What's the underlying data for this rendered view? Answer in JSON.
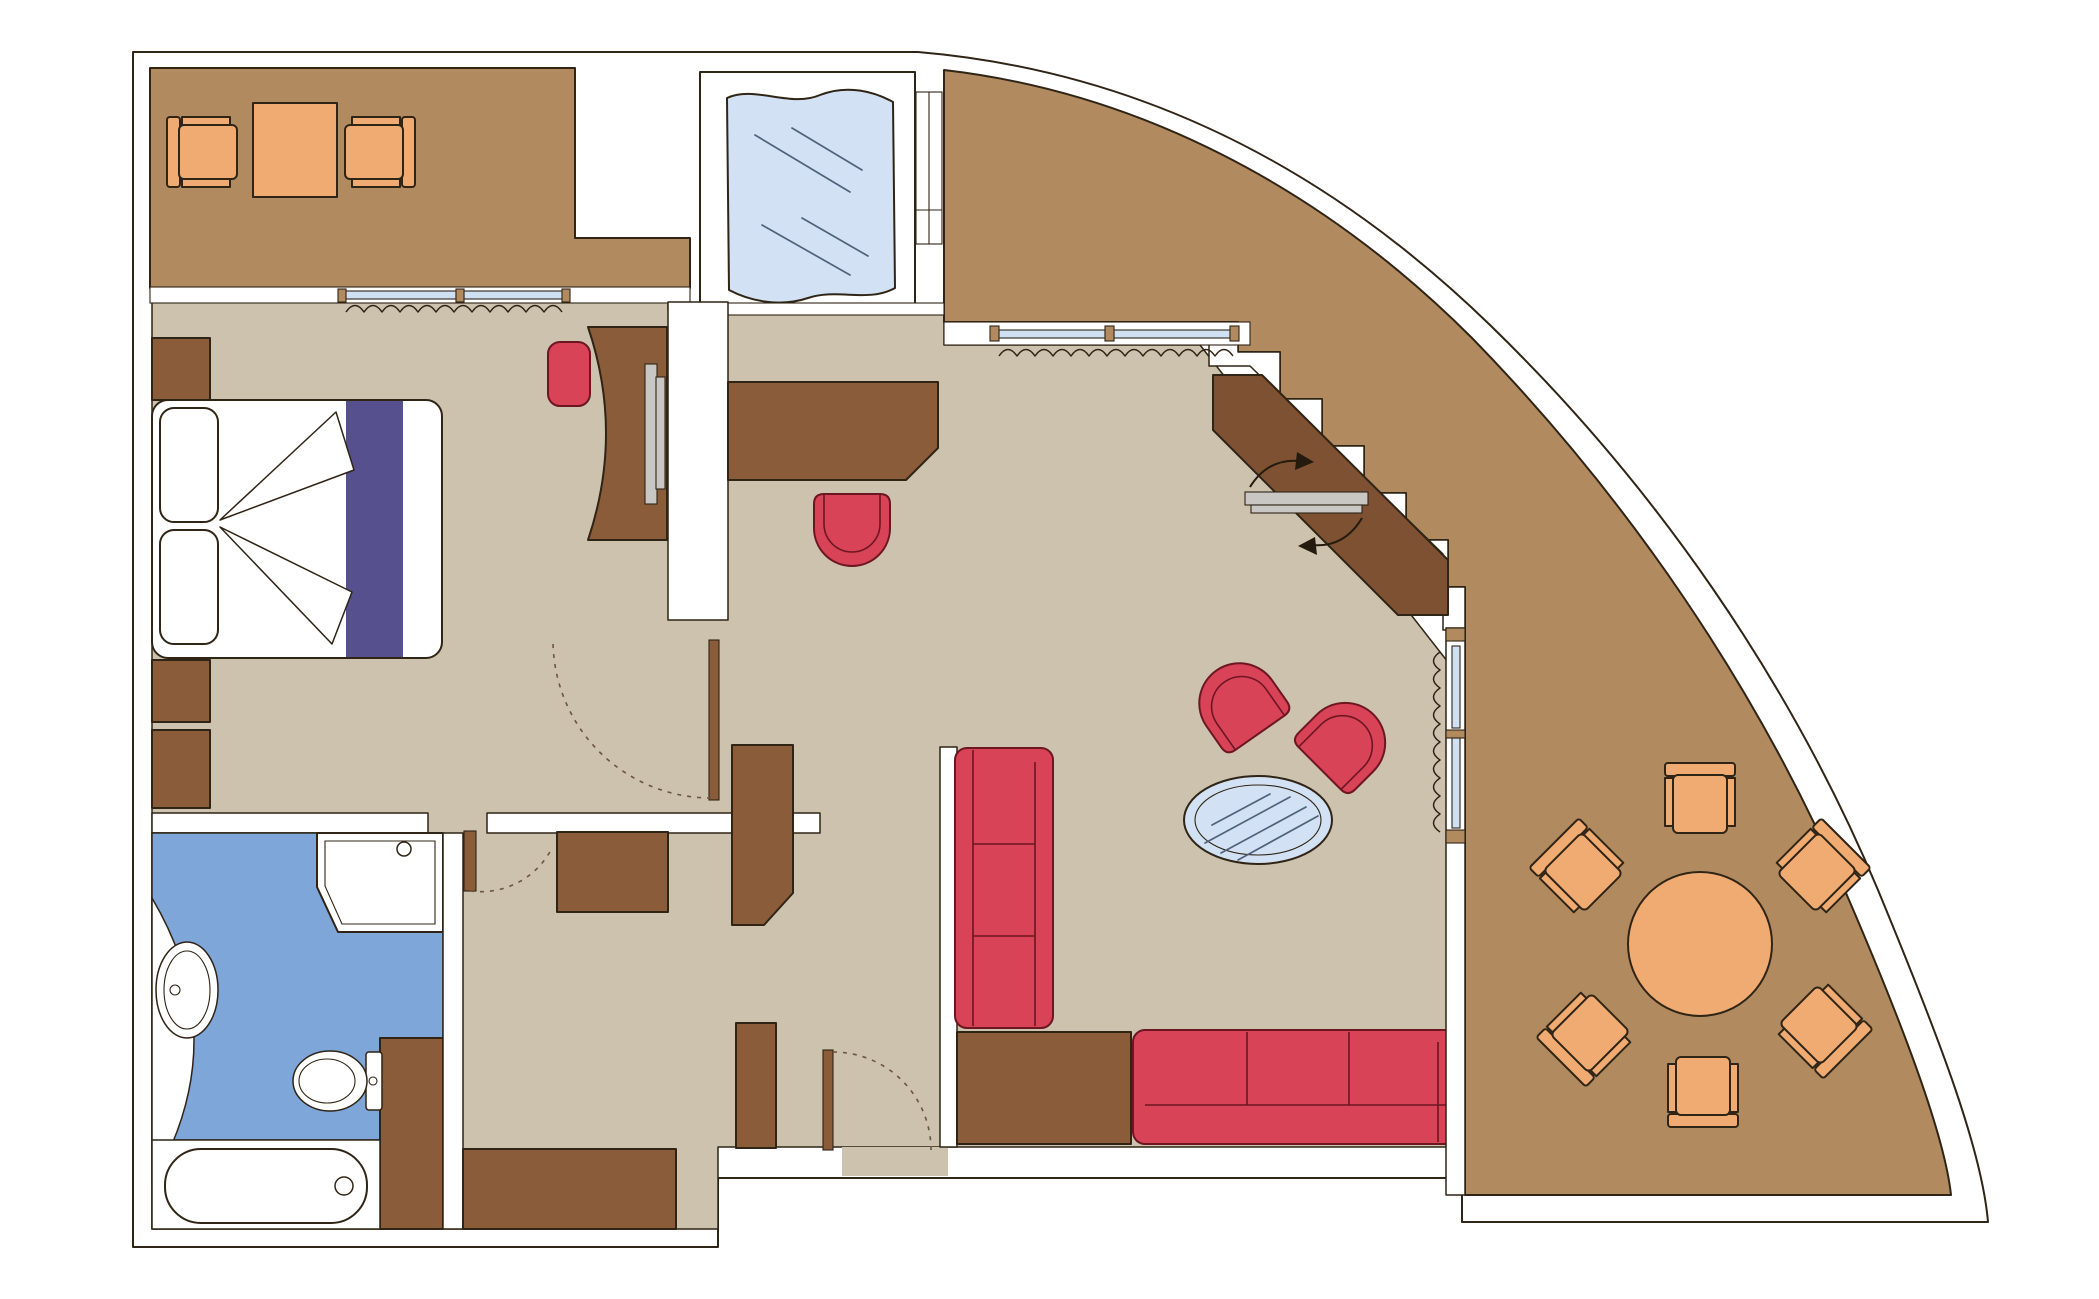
{
  "title": "Suite floor plan with curved terrace",
  "colors": {
    "wall": "#ffffff",
    "floor": "#ccc2ae",
    "terrace": "#b18a5f",
    "wood": "#8a5c3a",
    "wood_dark": "#7d5132",
    "bath": "#7ea6d8",
    "water": "#d2e2f4",
    "glass": "#cfe0f3",
    "red": "#d84357",
    "purple": "#57508e",
    "orange": "#efab72",
    "gray": "#c9c7c3",
    "white_fixture": "#ffffff"
  },
  "plan": {
    "rooms": [
      {
        "name": "balcony-lounge",
        "floor": "terrace",
        "furniture": [
          "armchair",
          "square-coffee-table",
          "armchair"
        ]
      },
      {
        "name": "whirlpool-deck",
        "floor": "wall",
        "furniture": [
          "whirlpool-glass-tub"
        ]
      },
      {
        "name": "bedroom",
        "floor": "floor",
        "furniture": [
          "nightstand",
          "double-bed-with-runner",
          "two-pillows",
          "nightstand",
          "cabinet",
          "desk-with-tv",
          "desk-chair"
        ]
      },
      {
        "name": "bathroom",
        "floor": "bath",
        "furniture": [
          "washbasin-counter",
          "toilet",
          "shower-cabin",
          "bathtub",
          "storage-cabinet"
        ]
      },
      {
        "name": "hallway",
        "floor": "floor",
        "furniture": [
          "dresser",
          "wardrobe",
          "closet-column",
          "entry-closet"
        ]
      },
      {
        "name": "living-room",
        "floor": "floor",
        "furniture": [
          "console-desk",
          "desk-chair",
          "sofa-3-seat-vertical",
          "sideboard",
          "sofa-3-seat-horizontal",
          "tub-armchair",
          "tub-armchair",
          "oval-glass-table",
          "diagonal-tv-cabinet",
          "swivel-tv"
        ]
      },
      {
        "name": "terrace-dining",
        "floor": "terrace",
        "furniture": [
          "round-dining-table",
          "dining-chair",
          "dining-chair",
          "dining-chair",
          "dining-chair",
          "dining-chair",
          "dining-chair"
        ]
      }
    ],
    "windows": [
      "bedroom-window-2-panes",
      "living-room-window-2-panes",
      "terrace-side-window-2-panes",
      "whirlpool-side-frames"
    ],
    "curtains": [
      "bedroom-curtain",
      "living-room-curtain",
      "terrace-side-curtain"
    ],
    "doors": [
      "entry-door-with-swing",
      "bedroom-door-with-swing",
      "bathroom-door-with-swing"
    ],
    "annotations": [
      "tv-swivel-arrows"
    ]
  }
}
